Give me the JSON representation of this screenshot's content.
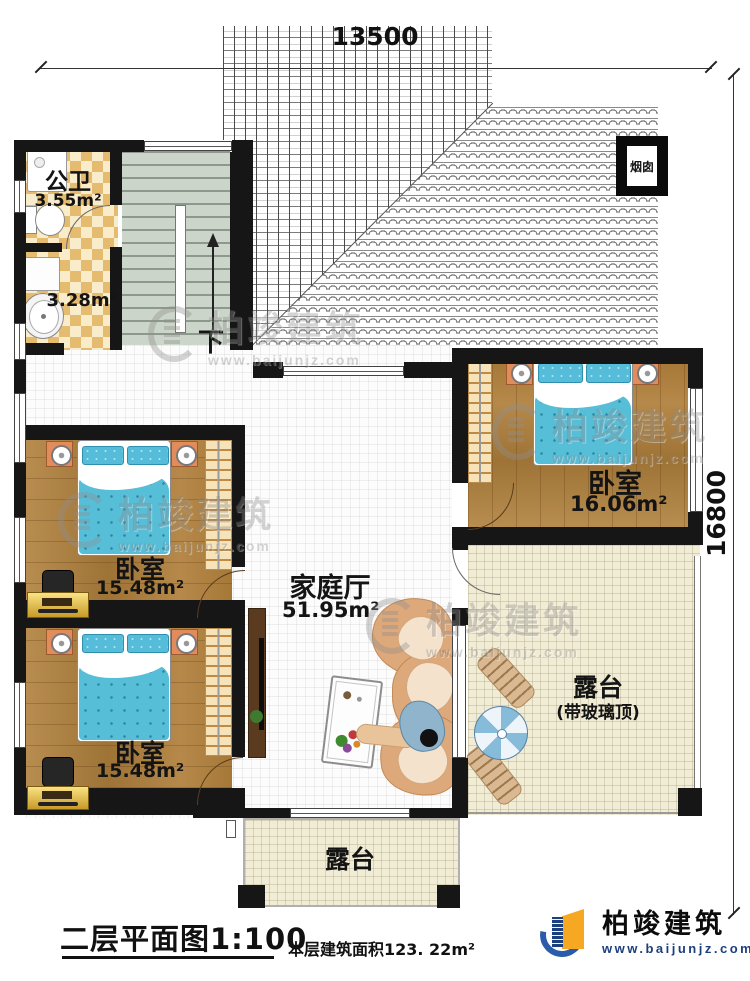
{
  "dimensions": {
    "top": "13500",
    "right": "16800"
  },
  "rooms": {
    "bathroom": {
      "name": "公卫",
      "area": "3.55m²"
    },
    "washroom": {
      "area": "3.28m²"
    },
    "bedroom_right": {
      "name": "卧室",
      "area": "16.06m²"
    },
    "bedroom_mid": {
      "name": "卧室",
      "area": "15.48m²"
    },
    "bedroom_bottom": {
      "name": "卧室",
      "area": "15.48m²"
    },
    "family_hall": {
      "name": "家庭厅",
      "area": "51.95m²"
    },
    "terrace_right": {
      "name": "露台",
      "note": "(带玻璃顶)"
    },
    "terrace_bottom": {
      "name": "露台"
    },
    "chimney": {
      "name": "烟囱"
    }
  },
  "stairs": {
    "down_label": "下"
  },
  "watermark": {
    "name": "柏竣建筑",
    "url": "www.baijunjz.com"
  },
  "footer": {
    "title": "二层平面图1:100",
    "area_note": "本层建筑面积123. 22m²"
  },
  "brand": {
    "name": "柏竣建筑",
    "url": "www.baijunjz.com"
  },
  "colors": {
    "wood": "#b0803c",
    "bed_blue": "#57bed8",
    "terrace": "#f1ecd6",
    "accent_orange": "#f7a823",
    "accent_blue": "#2a5caa"
  }
}
